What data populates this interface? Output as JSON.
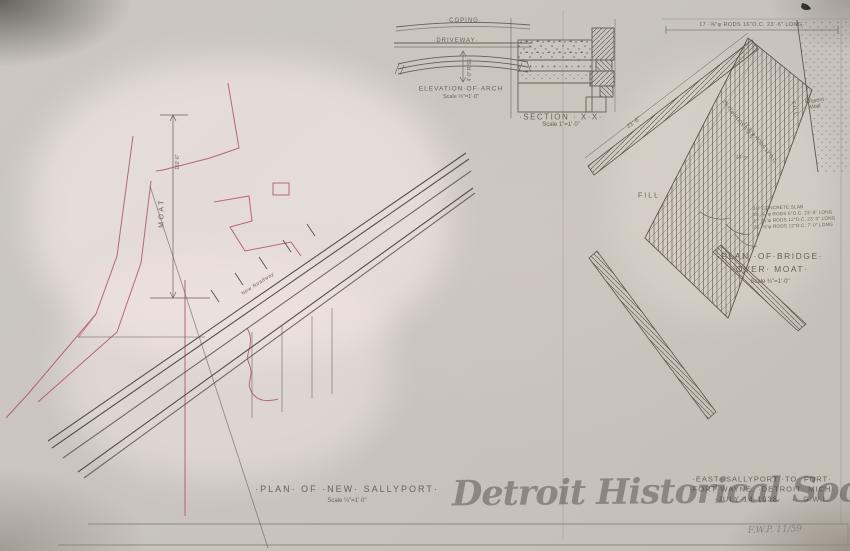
{
  "sheet": {
    "watermark": "Detroit Historical Society",
    "catalog_note": "F.W.P. 11/59"
  },
  "sallyport_plan": {
    "title": "·PLAN· OF ·NEW· SALLYPORT·",
    "scale": "Scale ¼\"=1'·0\"",
    "moat_label": "MOAT",
    "moat_dim": "110'·6\"",
    "roadway_label": "New Roadway"
  },
  "arch_elevation": {
    "coping_label": "·COPING·",
    "driveway_label": "·DRIVEWAY·",
    "rise_label": "4'·0\" RISE",
    "title": "ELEVATION·OF·ARCH",
    "scale": "Scale ½\"=1'·0\""
  },
  "section_xx": {
    "title": "·SECTION · X·X·",
    "scale": "Scale 1\"=1'·0\""
  },
  "bridge_plan": {
    "top_rod_note": "17 ·⅝\"φ RODS 16\"O.C. 23'·6\" LONG·",
    "span_dim": "21'·6\"",
    "fill_label": "FILL",
    "fill_label_right": "FILL",
    "present_wall_line1": "Present",
    "present_wall_line2": "Wall",
    "rod_note_diag1": "25·⅝\"φ RODS 6\"O.C.",
    "rod_note_diag2": "17·⅝\"φ RODS 12\"O.C.",
    "slab_dim": "13'·0\"",
    "notes": [
      "10\" CONCRETE SLAB",
      "25 ·⅝\"φ RODS 6\"O.C. 23'·6\" LONG",
      "17 ·⅝\"φ RODS 12\"O.C. 23'·0\" LONG",
      "26 ·⅝\"φ RODS 12\"O.C. 7'·0\" LONG"
    ],
    "title_line1": "·PLAN ·OF·BRIDGE·",
    "title_line2": "·OVER· MOAT·",
    "scale": "Scale ¾\"=1'·0\""
  },
  "title_block": {
    "line1": "·EAST· SALLYPORT ·TO· FORT·",
    "line2": "·FORT·WAYNE. ·DETROIT· MICH·",
    "line3": "·JULY·14·1938·",
    "initials": "G.W.I."
  }
}
